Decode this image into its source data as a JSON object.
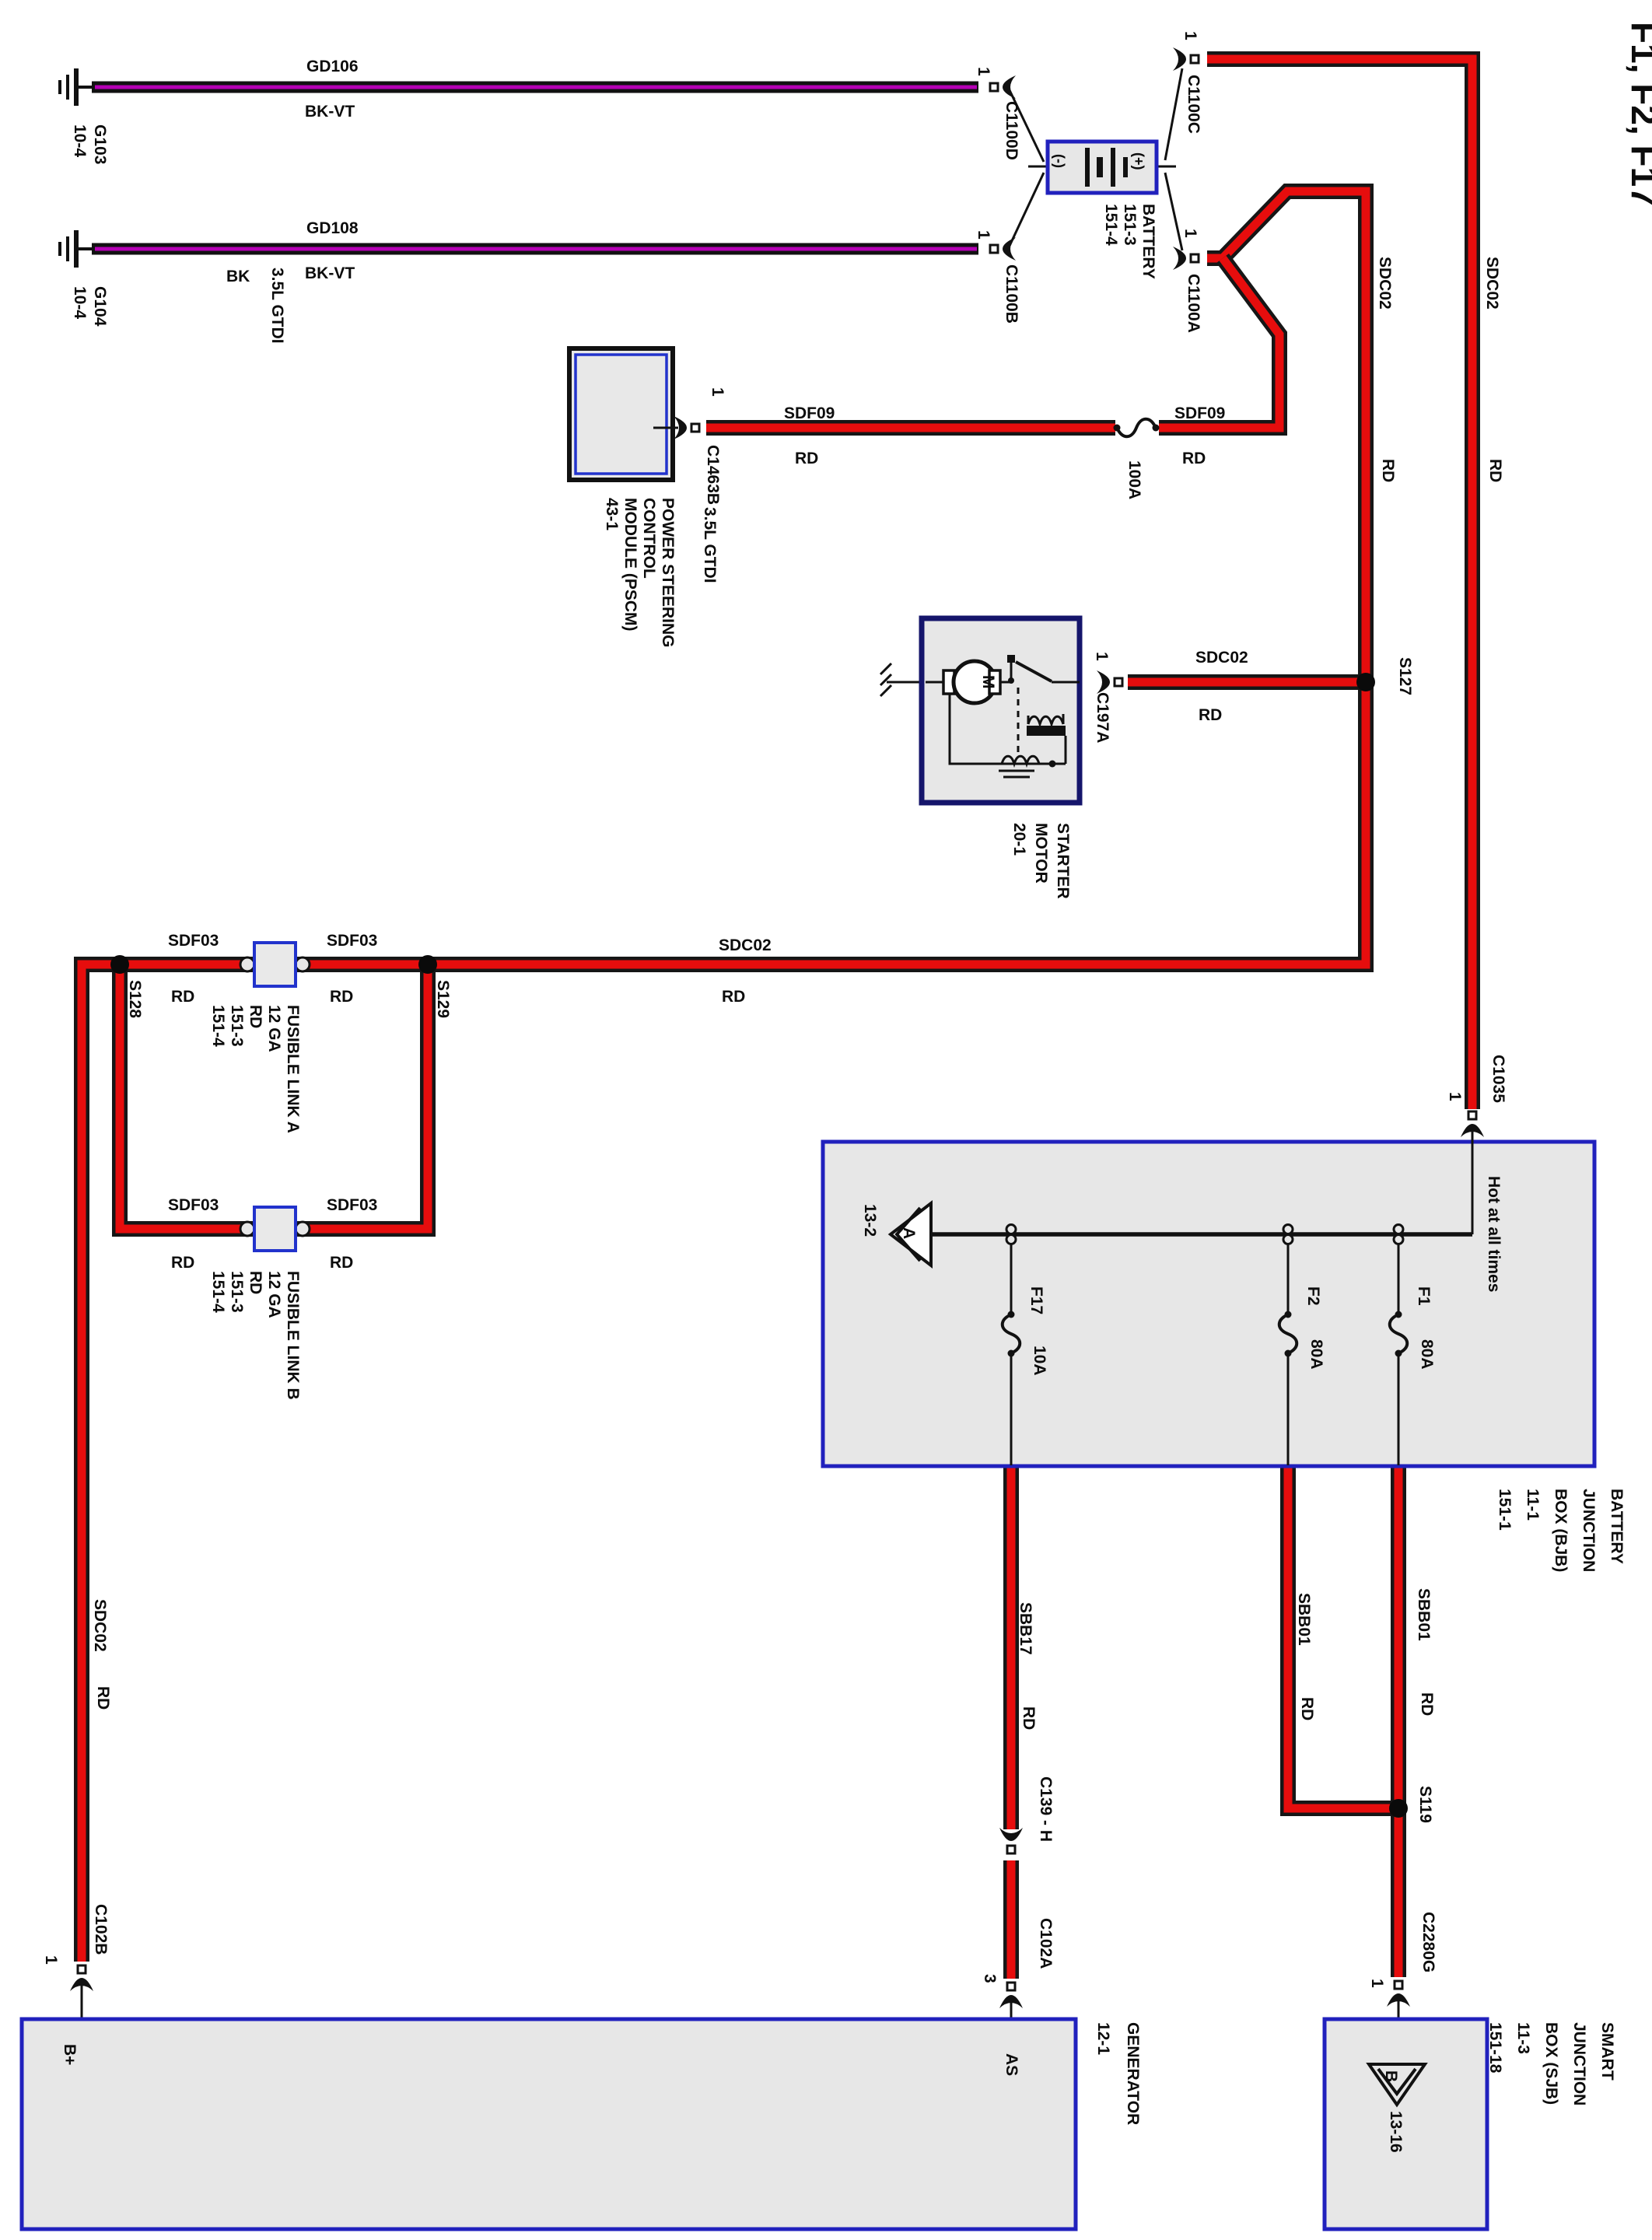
{
  "title": "F1, F2, F17",
  "grounds": {
    "g103": {
      "name": "G103",
      "ref": "10-4"
    },
    "g104": {
      "name": "G104",
      "ref": "10-4"
    }
  },
  "wires": {
    "gd106": {
      "name": "GD106",
      "color": "BK-VT"
    },
    "gd108": {
      "name": "GD108",
      "color": "BK-VT"
    },
    "sdf09_left": {
      "name": "SDF09",
      "color": "RD"
    },
    "sdf09_right": {
      "name": "SDF09",
      "color": "RD"
    },
    "sdc02_starter": {
      "name": "SDC02",
      "color": "RD"
    },
    "sdc02_inner": {
      "name": "SDC02",
      "color": "RD"
    },
    "sdc02_outer": {
      "name": "SDC02",
      "color": "RD"
    },
    "sdc02_main": {
      "name": "SDC02",
      "color": "RD"
    },
    "sdc02_left": {
      "name": "SDC02",
      "color": "RD"
    },
    "sdf03_a_left": {
      "name": "SDF03",
      "color": "RD"
    },
    "sdf03_a_right": {
      "name": "SDF03",
      "color": "RD"
    },
    "sdf03_b_left": {
      "name": "SDF03",
      "color": "RD"
    },
    "sdf03_b_right": {
      "name": "SDF03",
      "color": "RD"
    },
    "sbb17": {
      "name": "SBB17",
      "color": "RD"
    },
    "sbb01_f2": {
      "name": "SBB01",
      "color": "RD"
    },
    "sbb01_f1": {
      "name": "SBB01",
      "color": "RD"
    }
  },
  "connectors": {
    "c1100d": "C1100D",
    "c1100b": "C1100B",
    "c1100c": "C1100C",
    "c1100a": "C1100A",
    "c1463b": "C1463B",
    "c197a": "C197A",
    "c1035": "C1035",
    "c139": "C139 - H",
    "c102a": "C102A",
    "c2280g": "C2280G",
    "c102b": "C102B"
  },
  "pins": {
    "p1": "1",
    "p3": "3"
  },
  "splices": {
    "s127": "S127",
    "s128": "S128",
    "s129": "S129",
    "s119": "S119"
  },
  "battery": {
    "lines": [
      "BATTERY",
      "151-3",
      "151-4"
    ],
    "neg": "(-)",
    "pos": "(+)"
  },
  "engine_tag": {
    "bk": "BK",
    "gtdi_top": "3.5L GTDI",
    "gtdi_pscm": "3.5L GTDI"
  },
  "pscm": {
    "lines": [
      "POWER STEERING",
      "CONTROL",
      "MODULE (PSCM)",
      "43-1"
    ]
  },
  "starter": {
    "lines": [
      "STARTER",
      "MOTOR",
      "20-1"
    ],
    "motor": "M"
  },
  "fusible_link_100a": "100A",
  "link_a": {
    "lines": [
      "FUSIBLE LINK A",
      "12 GA",
      "RD",
      "151-3",
      "151-4"
    ]
  },
  "link_b": {
    "lines": [
      "FUSIBLE LINK B",
      "12 GA",
      "RD",
      "151-3",
      "151-4"
    ]
  },
  "bjb": {
    "lines": [
      "BATTERY",
      "JUNCTION",
      "BOX (BJB)",
      "11-1",
      "151-1"
    ],
    "hot": "Hot at all times",
    "arrow": "A",
    "ref": "13-2",
    "fuses": [
      {
        "name": "F17",
        "amp": "10A"
      },
      {
        "name": "F2",
        "amp": "80A"
      },
      {
        "name": "F1",
        "amp": "80A"
      }
    ]
  },
  "sjb": {
    "lines": [
      "SMART",
      "JUNCTION",
      "BOX (SJB)",
      "11-3",
      "151-18"
    ],
    "arrow": "B",
    "ref": "13-16"
  },
  "generator": {
    "lines": [
      "GENERATOR",
      "12-1"
    ],
    "as_pin": "AS",
    "bplus_pin": "B+"
  }
}
